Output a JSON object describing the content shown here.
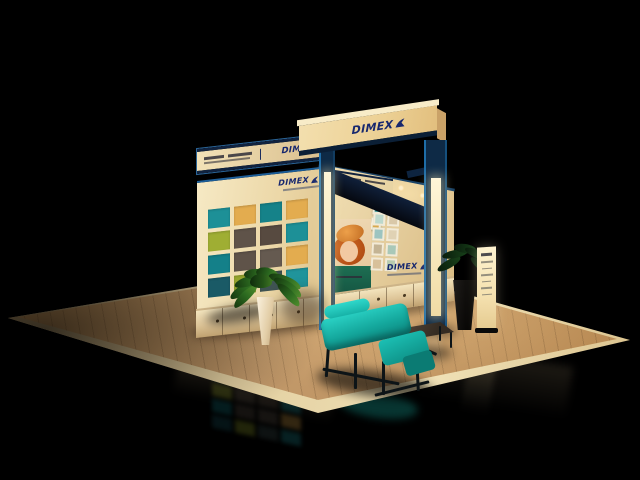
{
  "scene": {
    "setting": "3d-render-exhibition-booth",
    "environment": "dark-hall",
    "canvas": {
      "width": 640,
      "height": 480
    }
  },
  "brand": {
    "name": "DIMEX",
    "logo_color": "#16276e",
    "swoosh_color": "#16276e"
  },
  "signs": {
    "fascia_logo": "DIMEX",
    "left_header_logo": "DIMEX",
    "left_panel_logo": "DIMEX",
    "back_wall_logo": "DIMEX"
  },
  "left_wall": {
    "tile_grid": {
      "rows": 4,
      "cols": 4
    },
    "tile_colors": [
      "#1d9097",
      "#e3ac4f",
      "#158289",
      "#e3ac4f",
      "#9fae33",
      "#5f5349",
      "#574a40",
      "#1d9097",
      "#148089",
      "#5f5349",
      "#655a50",
      "#e3ac4f",
      "#1a5a66",
      "#96a52e",
      "#3f5352",
      "#20949b"
    ]
  },
  "back_wall": {
    "poster_subject": "portrait-child-orange-hat",
    "photo_thumbnails": 8,
    "framed_pictures": 3
  },
  "objects": {
    "sofa": "teal-metal-frame-sofa",
    "coffee_table": "dark-wood-table",
    "planter_front": "white-vase-green-plant",
    "planter_right": "dark-pot-palm",
    "totem": "freestanding-banner-stand"
  },
  "palette": {
    "background": "#000000",
    "panel_cream": "#f0e0b6",
    "trim_blue": "#1e6da8",
    "trim_navy": "#0e2a46",
    "sofa_teal": "#17b2a7",
    "floor_wood": "#b98d55",
    "floor_edge": "#ddc694"
  }
}
